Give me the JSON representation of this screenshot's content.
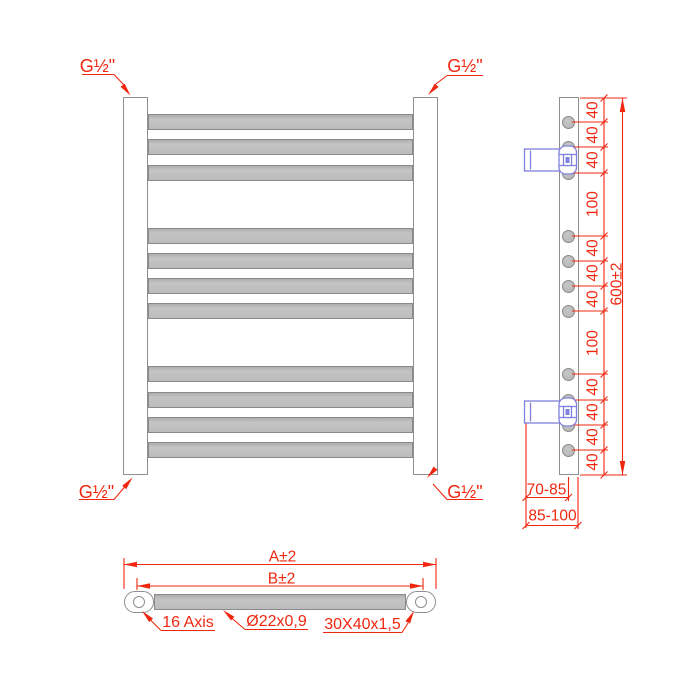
{
  "connections": {
    "top_left": "G½\"",
    "top_right": "G½\"",
    "bottom_left": "G½\"",
    "bottom_right": "G½\""
  },
  "side_view": {
    "overall_height": "600±2",
    "segments": [
      "40",
      "40",
      "40",
      "100",
      "40",
      "40",
      "40",
      "100",
      "40",
      "40",
      "40",
      "40"
    ],
    "wall_to_axis": "70-85",
    "wall_to_front": "85-100"
  },
  "top_view": {
    "overall_width": "A±2",
    "centers_width": "B±2",
    "axis_note": "16 Axis",
    "tube_spec": "Ø22x0,9",
    "profile_spec": "30X40x1,5"
  },
  "colors": {
    "dimension_red": "#f0270f",
    "bracket_blue": "#8080dd",
    "tube_gray": "#bdbdbd",
    "outline_gray": "#8f8f8f"
  }
}
